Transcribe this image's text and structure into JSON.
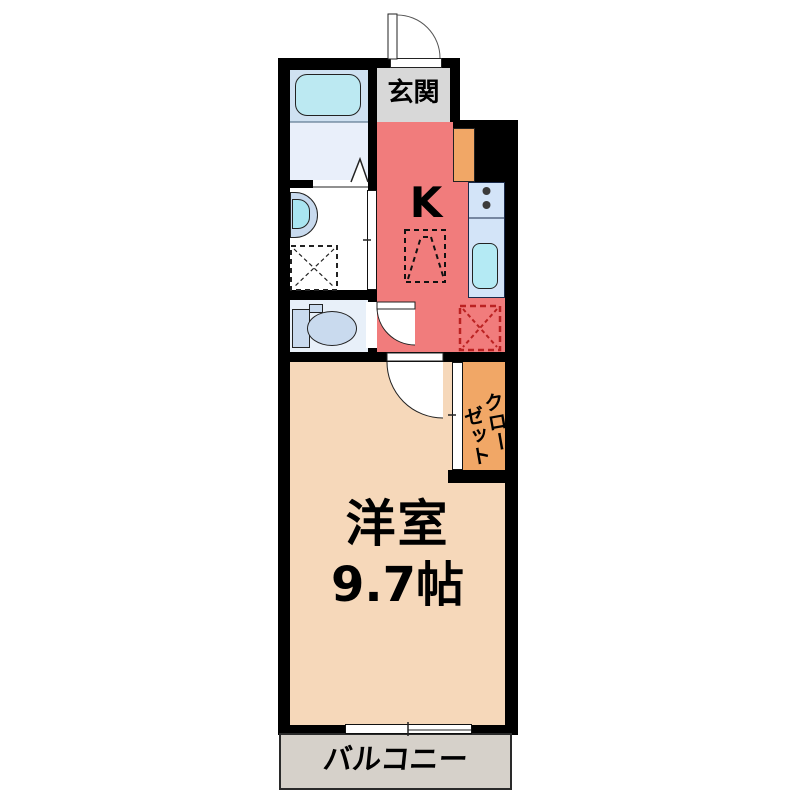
{
  "plan": {
    "type": "japanese-apartment-floor-plan",
    "rooms": {
      "entrance": {
        "label": "玄関"
      },
      "kitchen": {
        "label": "K"
      },
      "closet": {
        "label": "クローゼット",
        "line_right": "クロー",
        "line_left": "ゼット"
      },
      "western_room": {
        "label": "洋室",
        "size": "9.7帖"
      },
      "balcony": {
        "label": "バルコニー"
      }
    },
    "fixture_icons": [
      "bathtub-icon",
      "folding-door-icon",
      "washbasin-icon",
      "washing-machine-space-icon",
      "toilet-icon",
      "stove-burners-icon",
      "kitchen-sink-icon",
      "refrigerator-space-icon",
      "service-space-icon",
      "cabinet-icon",
      "entrance-door-arc-icon",
      "room-door-arc-icon",
      "toilet-door-arc-icon",
      "sliding-door-icon",
      "window-icon"
    ],
    "colors": {
      "wall": "#000000",
      "kitchen": "#f17c7c",
      "entrance": "#d8d8d8",
      "western_room": "#f6d8ba",
      "closet": "#f1a766",
      "balcony": "#d6d1ca",
      "bathroom_upper": "#cfe1f1",
      "bathroom_lower": "#e9effa",
      "bathtub": "#bce9f2",
      "toilet_room": "#e8f0f9",
      "fixture_blue": "#c9daee",
      "counter": "#d3e4f8",
      "sink": "#b4eaf4",
      "dashed_marker_red": "#bb2222"
    }
  }
}
